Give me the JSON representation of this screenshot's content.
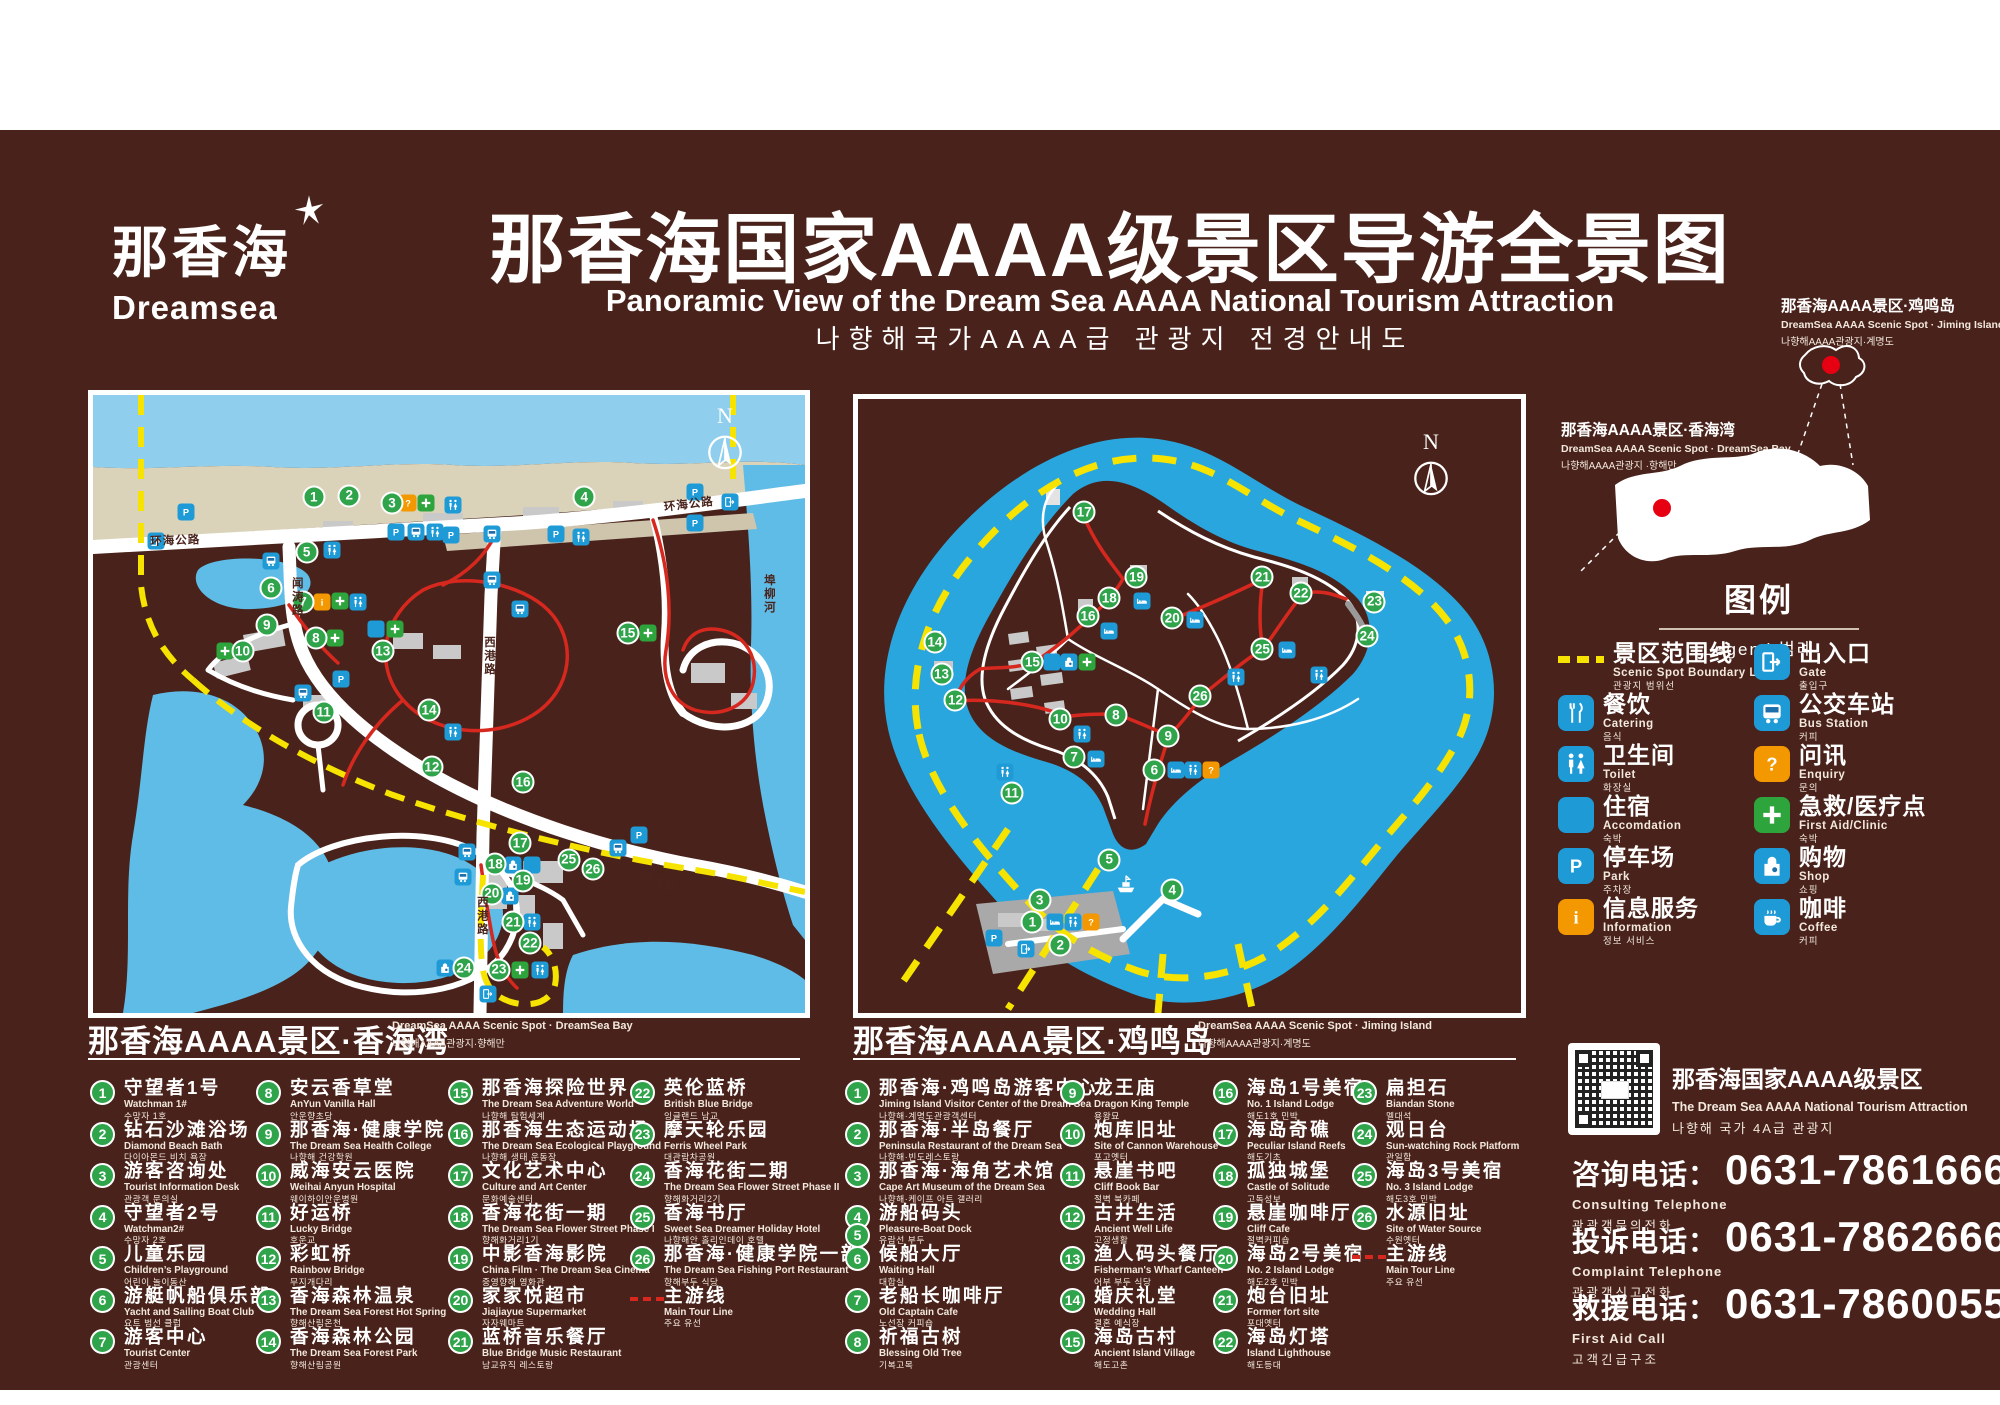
{
  "header": {
    "logo_cn": "那香海",
    "logo_en": "Dreamsea",
    "title_cn": "那香海国家AAAA级景区导游全景图",
    "title_en": "Panoramic View of the Dream Sea AAAA National Tourism Attraction",
    "title_kr": "나향해국가AAAA급 관광지 전경안내도"
  },
  "inset": {
    "jiming": {
      "cn": "那香海AAAA景区·鸡鸣岛",
      "en": "DreamSea AAAA Scenic Spot · Jiming Island",
      "kr": "나향해AAAA관광지·계명도"
    },
    "bay": {
      "cn": "那香海AAAA景区·香海湾",
      "en": "DreamSea AAAA Scenic Spot · DreamSea Bay",
      "kr": "나향해AAAA관광지 ·항해만"
    }
  },
  "legend": {
    "title_cn": "图例",
    "title_sub": "Legend 범례",
    "colors": {
      "blue": "#1E9BD7",
      "orange": "#F39800",
      "green": "#2EA43C",
      "yellow": "#F6E400",
      "red": "#D6281E"
    },
    "items": [
      {
        "type": "boundary",
        "cn": "景区范围线",
        "en": "Scenic Spot Boundary Line",
        "kr": "관광지 범위선"
      },
      {
        "type": "gate",
        "cn": "出入口",
        "en": "Gate",
        "kr": "출입구"
      },
      {
        "type": "catering",
        "cn": "餐饮",
        "en": "Catering",
        "kr": "음식"
      },
      {
        "type": "bus",
        "cn": "公交车站",
        "en": "Bus Station",
        "kr": "커피"
      },
      {
        "type": "toilet",
        "cn": "卫生间",
        "en": "Toilet",
        "kr": "화장실"
      },
      {
        "type": "enquiry",
        "cn": "问讯",
        "en": "Enquiry",
        "kr": "문의"
      },
      {
        "type": "accommodation",
        "cn": "住宿",
        "en": "Accomdation",
        "kr": "숙박"
      },
      {
        "type": "firstaid",
        "cn": "急救/医疗点",
        "en": "First Aid/Clinic",
        "kr": "숙박"
      },
      {
        "type": "park",
        "cn": "停车场",
        "en": "Park",
        "kr": "주차장"
      },
      {
        "type": "shop",
        "cn": "购物",
        "en": "Shop",
        "kr": "쇼핑"
      },
      {
        "type": "information",
        "cn": "信息服务",
        "en": "Information",
        "kr": "정보 서비스"
      },
      {
        "type": "coffee",
        "cn": "咖啡",
        "en": "Coffee",
        "kr": "커피"
      }
    ]
  },
  "maps": {
    "bay": {
      "compass": "N",
      "road_labels": [
        {
          "t": "环海公路",
          "x": 8,
          "y": 22.3,
          "r": -2
        },
        {
          "t": "环海公路",
          "x": 80,
          "y": 16.8,
          "r": -7
        },
        {
          "t": "闻涛路",
          "x": 27.5,
          "y": 29.5,
          "v": 1
        },
        {
          "t": "西港路",
          "x": 54.5,
          "y": 39,
          "v": 1
        },
        {
          "t": "西港路",
          "x": 53.5,
          "y": 81,
          "v": 1
        },
        {
          "t": "闻涛路",
          "x": 77.5,
          "y": 76.5,
          "r": 22
        },
        {
          "t": "埠柳河",
          "x": 93.8,
          "y": 29,
          "v": 1
        }
      ],
      "num_markers": [
        [
          1,
          31,
          16.5
        ],
        [
          2,
          36,
          16.3
        ],
        [
          3,
          42,
          17.5
        ],
        [
          4,
          69,
          16.5
        ],
        [
          5,
          30,
          25.4
        ],
        [
          6,
          25,
          31.2
        ],
        [
          7,
          29.5,
          33.5
        ],
        [
          8,
          31.3,
          39.3
        ],
        [
          9,
          24.4,
          37.2
        ],
        [
          10,
          21,
          41.4
        ],
        [
          11,
          32.4,
          51.3
        ],
        [
          12,
          47.6,
          60.2
        ],
        [
          13,
          40.7,
          41.4
        ],
        [
          14,
          47.2,
          51
        ],
        [
          15,
          75.1,
          38.5
        ],
        [
          16,
          60.4,
          62.6
        ],
        [
          17,
          60,
          72.5
        ],
        [
          18,
          56.5,
          75.9
        ],
        [
          19,
          60.4,
          78.6
        ],
        [
          20,
          56,
          80.7
        ],
        [
          21,
          59,
          85.3
        ],
        [
          22,
          61.4,
          88.7
        ],
        [
          23,
          57,
          93
        ],
        [
          24,
          52.1,
          92.7
        ],
        [
          25,
          66.8,
          75.2
        ],
        [
          26,
          70.2,
          76.7
        ]
      ],
      "icon_markers": [
        [
          "q",
          44.3,
          17.5
        ],
        [
          "aid",
          46.8,
          17.5
        ],
        [
          "wc",
          50.5,
          17.8
        ],
        [
          "p",
          13,
          19
        ],
        [
          "p",
          84.5,
          15.7
        ],
        [
          "p",
          84.5,
          20.7
        ],
        [
          "gate",
          89.5,
          17.3
        ],
        [
          "gate",
          8.8,
          23.6
        ],
        [
          "wc",
          33.5,
          25
        ],
        [
          "p",
          42.5,
          22.2
        ],
        [
          "bus",
          45.3,
          22.2
        ],
        [
          "wc",
          48,
          22.2
        ],
        [
          "p",
          50.3,
          22.7
        ],
        [
          "bus",
          56,
          22.5
        ],
        [
          "p",
          65,
          22.5
        ],
        [
          "wc",
          68.5,
          23
        ],
        [
          "bus",
          25,
          26.8
        ],
        [
          "i",
          32.2,
          33.5
        ],
        [
          "aid",
          34.7,
          33.3
        ],
        [
          "wc",
          37.2,
          33.5
        ],
        [
          "aid",
          18.5,
          41.4
        ],
        [
          "aid",
          34,
          39.3
        ],
        [
          "cater",
          39.7,
          37.9
        ],
        [
          "aid",
          42.4,
          37.9
        ],
        [
          "aid",
          78,
          38.5
        ],
        [
          "bus",
          56,
          30
        ],
        [
          "bus",
          60,
          34.6
        ],
        [
          "bus",
          29.5,
          48.2
        ],
        [
          "p",
          34.8,
          46
        ],
        [
          "wc",
          50.6,
          54.5
        ],
        [
          "p",
          76.7,
          71.2
        ],
        [
          "bus",
          73.7,
          73.3
        ],
        [
          "bus",
          52.5,
          74
        ],
        [
          "shop",
          59,
          76
        ],
        [
          "cater",
          61.7,
          76
        ],
        [
          "bus",
          52,
          78
        ],
        [
          "shop",
          58.6,
          81
        ],
        [
          "wc",
          61.7,
          85.3
        ],
        [
          "shop",
          49.4,
          92.7
        ],
        [
          "aid",
          60,
          93
        ],
        [
          "wc",
          62.8,
          93
        ],
        [
          "gate",
          55.5,
          97
        ]
      ]
    },
    "island": {
      "compass": "N",
      "road_labels": [],
      "num_markers": [
        [
          1,
          26.3,
          85.2
        ],
        [
          2,
          30.5,
          88.9
        ],
        [
          3,
          27.4,
          81.6
        ],
        [
          4,
          47.4,
          80
        ],
        [
          5,
          37.9,
          75
        ],
        [
          6,
          44.7,
          60.4
        ],
        [
          7,
          32.6,
          58.3
        ],
        [
          8,
          38.9,
          51.5
        ],
        [
          9,
          46.8,
          54.9
        ],
        [
          10,
          30.5,
          52.1
        ],
        [
          11,
          23.2,
          64.2
        ],
        [
          12,
          14.7,
          49
        ],
        [
          13,
          12.6,
          44.8
        ],
        [
          14,
          11.6,
          39.6
        ],
        [
          15,
          26.3,
          42.8
        ],
        [
          16,
          34.7,
          35.4
        ],
        [
          17,
          34.1,
          18.4
        ],
        [
          18,
          37.9,
          32.4
        ],
        [
          19,
          42,
          29
        ],
        [
          20,
          47.4,
          35.7
        ],
        [
          21,
          61,
          29
        ],
        [
          22,
          66.8,
          31.6
        ],
        [
          23,
          77.9,
          33
        ],
        [
          24,
          76.8,
          38.6
        ],
        [
          25,
          61,
          40.7
        ],
        [
          26,
          51.6,
          48.4
        ]
      ],
      "icon_markers": [
        [
          "wc",
          22.2,
          60.7
        ],
        [
          "bed",
          35.9,
          58.6
        ],
        [
          "bed",
          48,
          60.4
        ],
        [
          "wc",
          50.6,
          60.4
        ],
        [
          "q",
          53.2,
          60.4
        ],
        [
          "wc",
          33.8,
          54.6
        ],
        [
          "cater",
          29.3,
          42.8
        ],
        [
          "shop",
          31.9,
          42.8
        ],
        [
          "aid",
          34.5,
          42.8
        ],
        [
          "bed",
          37.9,
          37.8
        ],
        [
          "bed",
          42.8,
          32.9
        ],
        [
          "bed",
          50.8,
          36
        ],
        [
          "bed",
          64.7,
          40.9
        ],
        [
          "wc",
          69.5,
          44.9
        ],
        [
          "wc",
          57,
          45.2
        ],
        [
          "boat",
          40.4,
          79
        ],
        [
          "p",
          20.5,
          87.8
        ],
        [
          "gate",
          25.3,
          89.6
        ],
        [
          "bed",
          29.7,
          85.2
        ],
        [
          "wc",
          32.4,
          85.2
        ],
        [
          "q",
          35.1,
          85.2
        ]
      ]
    }
  },
  "sections": {
    "bay": {
      "cn": "那香海AAAA景区·香海湾",
      "en": "DreamSea AAAA Scenic Spot · DreamSea Bay",
      "kr": "나향해AAAA관광지·향해만",
      "tour": {
        "cn": "主游线",
        "en": "Main Tour Line",
        "kr": "주요 유선"
      },
      "items": [
        {
          "n": "1",
          "cn": "守望者1号",
          "en": "Watchman 1#",
          "kr": "수망자 1호"
        },
        {
          "n": "2",
          "cn": "钻石沙滩浴场",
          "en": "Diamond Beach Bath",
          "kr": "다이아몬드 비치 욕장"
        },
        {
          "n": "3",
          "cn": "游客咨询处",
          "en": "Tourist Information Desk",
          "kr": "관광객 문의실"
        },
        {
          "n": "4",
          "cn": "守望者2号",
          "en": "Watchman2#",
          "kr": "수망자 2호"
        },
        {
          "n": "5",
          "cn": "儿童乐园",
          "en": "Children’s Playground",
          "kr": "어린이 놀이동산"
        },
        {
          "n": "6",
          "cn": "游艇帆船俱乐部",
          "en": "Yacht and Sailing Boat Club",
          "kr": "요트 범선 클럽"
        },
        {
          "n": "7",
          "cn": "游客中心",
          "en": "Tourist Center",
          "kr": "관광센터"
        },
        {
          "n": "8",
          "cn": "安云香草堂",
          "en": "AnYun Vanilla Hall",
          "kr": "안운향초당"
        },
        {
          "n": "9",
          "cn": "那香海·健康学院",
          "en": "The Dream Sea Health College",
          "kr": "나향해 건강학원"
        },
        {
          "n": "10",
          "cn": "威海安云医院",
          "en": "Weihai Anyun Hospital",
          "kr": "웨이하이안운병원"
        },
        {
          "n": "11",
          "cn": "好运桥",
          "en": "Lucky Bridge",
          "kr": "호운교"
        },
        {
          "n": "12",
          "cn": "彩虹桥",
          "en": "Rainbow Bridge",
          "kr": "무지개다리"
        },
        {
          "n": "13",
          "cn": "香海森林温泉",
          "en": "The Dream Sea Forest Hot Spring",
          "kr": "향해산림온천"
        },
        {
          "n": "14",
          "cn": "香海森林公园",
          "en": "The Dream Sea Forest Park",
          "kr": "향해산림공원"
        },
        {
          "n": "15",
          "cn": "那香海探险世界",
          "en": "The Dream Sea Adventure World",
          "kr": "나향해 탐험세계"
        },
        {
          "n": "16",
          "cn": "那香海生态运动场",
          "en": "The Dream Sea Ecological Playground",
          "kr": "나향해 생태 운동장"
        },
        {
          "n": "17",
          "cn": "文化艺术中心",
          "en": "Culture and Art Center",
          "kr": "문화예술센터"
        },
        {
          "n": "18",
          "cn": "香海花街一期",
          "en": "The Dream Sea Flower Street Phase I",
          "kr": "향해화거리1기"
        },
        {
          "n": "19",
          "cn": "中影香海影院",
          "en": "China Film · The Dream Sea Cinema",
          "kr": "중영향해 영화관"
        },
        {
          "n": "20",
          "cn": "家家悦超市",
          "en": "Jiajiayue Supermarket",
          "kr": "자자웨마트"
        },
        {
          "n": "21",
          "cn": "蓝桥音乐餐厅",
          "en": "Blue Bridge Music Restaurant",
          "kr": "남교유직 레스토랑"
        },
        {
          "n": "22",
          "cn": "英伦蓝桥",
          "en": "British Blue Bridge",
          "kr": "잉글랜드 남교"
        },
        {
          "n": "23",
          "cn": "摩天轮乐园",
          "en": "Ferris Wheel Park",
          "kr": "대관람차공원"
        },
        {
          "n": "24",
          "cn": "香海花街二期",
          "en": "The Dream Sea Flower Street Phase II",
          "kr": "향해화거리2기"
        },
        {
          "n": "25",
          "cn": "香海书厅",
          "en": "Sweet Sea Dreamer Holiday Hotel",
          "kr": "나향해안 홀리인데이 호텔"
        },
        {
          "n": "26",
          "cn": "那香海·健康学院一部",
          "en": "The Dream Sea Fishing Port Restaurant",
          "kr": "향해부두 식당"
        }
      ]
    },
    "island": {
      "cn": "那香海AAAA景区·鸡鸣岛",
      "en": "DreamSea AAAA Scenic Spot · Jiming Island",
      "kr": "나향해AAAA관광지·계명도",
      "tour": {
        "cn": "主游线",
        "en": "Main Tour Line",
        "kr": "주요 유선"
      },
      "items": [
        {
          "n": "1",
          "cn": "那香海·鸡鸣岛游客中心",
          "en": "Jiming Island Visitor Center of the Dream Sea",
          "kr": "나향해·계명도관광객센터"
        },
        {
          "n": "2",
          "cn": "那香海·半岛餐厅",
          "en": "Peninsula Restaurant of the Dream Sea",
          "kr": "나향해·빈도레스토랑"
        },
        {
          "n": "3",
          "cn": "那香海·海角艺术馆",
          "en": "Cape Art Museum of the Dream Sea",
          "kr": "나향해·케이프 아트 갤러리"
        },
        {
          "n": "4",
          "n2": "5",
          "cn": "游船码头",
          "en": "Pleasure-Boat Dock",
          "kr": "유람선 부두"
        },
        {
          "n": "6",
          "cn": "候船大厅",
          "en": "Waiting Hall",
          "kr": "대합실"
        },
        {
          "n": "7",
          "cn": "老船长咖啡厅",
          "en": "Old Captain Cafe",
          "kr": "노선장 커피숍"
        },
        {
          "n": "8",
          "cn": "祈福古树",
          "en": "Blessing Old Tree",
          "kr": "기복고목"
        },
        {
          "n": "9",
          "cn": "龙王庙",
          "en": "Dragon King Temple",
          "kr": "용왕묘"
        },
        {
          "n": "10",
          "cn": "炮库旧址",
          "en": "Site of Cannon Warehouse",
          "kr": "포고옛터"
        },
        {
          "n": "11",
          "cn": "悬崖书吧",
          "en": "Cliff Book Bar",
          "kr": "절벽 북카페"
        },
        {
          "n": "12",
          "cn": "古井生活",
          "en": "Ancient Well Life",
          "kr": "고정생활"
        },
        {
          "n": "13",
          "cn": "渔人码头餐厅",
          "en": "Fisherman's Wharf Canteen",
          "kr": "어부 부두 식당"
        },
        {
          "n": "14",
          "cn": "婚庆礼堂",
          "en": "Wedding Hall",
          "kr": "결혼 예식장"
        },
        {
          "n": "15",
          "cn": "海岛古村",
          "en": "Ancient Island Village",
          "kr": "해도고촌"
        },
        {
          "n": "16",
          "cn": "海岛1号美宿",
          "en": "No. 1 Island Lodge",
          "kr": "해도1호 민박"
        },
        {
          "n": "17",
          "cn": "海岛奇礁",
          "en": "Peculiar Island Reefs",
          "kr": "해도기초"
        },
        {
          "n": "18",
          "cn": "孤独城堡",
          "en": "Castle of Solitude",
          "kr": "고독성보"
        },
        {
          "n": "19",
          "cn": "悬崖咖啡厅",
          "en": "Cliff Cafe",
          "kr": "절벽커피숍"
        },
        {
          "n": "20",
          "cn": "海岛2号美宿",
          "en": "No. 2 Island Lodge",
          "kr": "해도2호 민박"
        },
        {
          "n": "21",
          "cn": "炮台旧址",
          "en": "Former fort site",
          "kr": "포대옛터"
        },
        {
          "n": "22",
          "cn": "海岛灯塔",
          "en": "Island Lighthouse",
          "kr": "해도등대"
        },
        {
          "n": "23",
          "cn": "扁担石",
          "en": "Biandan Stone",
          "kr": "멜대석"
        },
        {
          "n": "24",
          "cn": "观日台",
          "en": "Sun-watching Rock Platform",
          "kr": "관일함"
        },
        {
          "n": "25",
          "cn": "海岛3号美宿",
          "en": "No. 3 Island Lodge",
          "kr": "해도3호 민박"
        },
        {
          "n": "26",
          "cn": "水源旧址",
          "en": "Site of Water Source",
          "kr": "수원옛터"
        }
      ]
    }
  },
  "contact": {
    "qr_cn": "那香海国家AAAA级景区",
    "qr_en": "The Dream Sea AAAA National Tourism Attraction",
    "qr_kr": "나향해 국가 4A급 관광지",
    "phones": [
      {
        "cn": "咨询电话：",
        "number": "0631-7861666",
        "en": "Consulting Telephone",
        "kr": "관광객문의전화"
      },
      {
        "cn": "投诉电话：",
        "number": "0631-7862666",
        "en": "Complaint Telephone",
        "kr": "관광객신고전화"
      },
      {
        "cn": "救援电话：",
        "number": "0631-7860055",
        "en": "First Aid Call",
        "kr": "고객긴급구조"
      }
    ]
  }
}
